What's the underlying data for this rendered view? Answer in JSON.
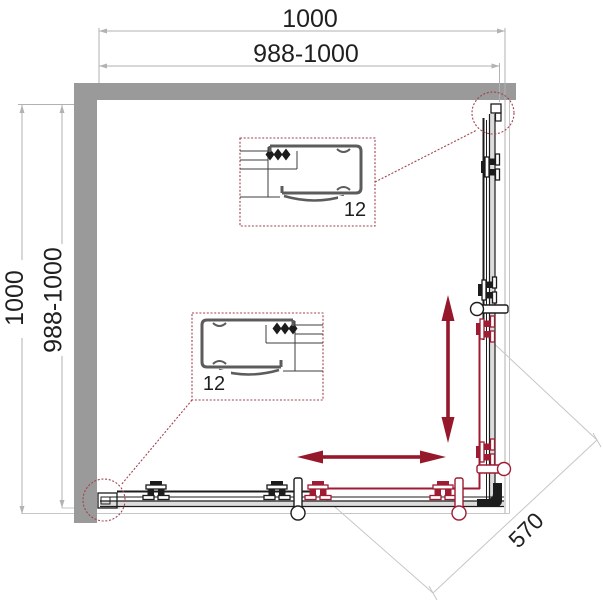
{
  "diagram": {
    "title": "corner-shower-enclosure-plan",
    "dimensions": {
      "top_outer": "1000",
      "top_inner": "988-1000",
      "left_outer": "1000",
      "left_inner": "988-1000",
      "diagonal_opening": "570"
    },
    "detail_callouts": {
      "upper_label": "12",
      "lower_label": "12"
    }
  },
  "colors": {
    "bg": "#ffffff",
    "wall": "#9a9a9a",
    "dimLine": "#b2b2b2",
    "dimText": "#1f1f1f",
    "lineDark": "#1c1c1c",
    "trayGray": "#c6c6c6",
    "railFill": "#dcdcdc",
    "profileGray": "#5c5c5c",
    "red": "#9e1b32",
    "arrowRed": "#96182b",
    "calloutRed": "#a0424c"
  }
}
